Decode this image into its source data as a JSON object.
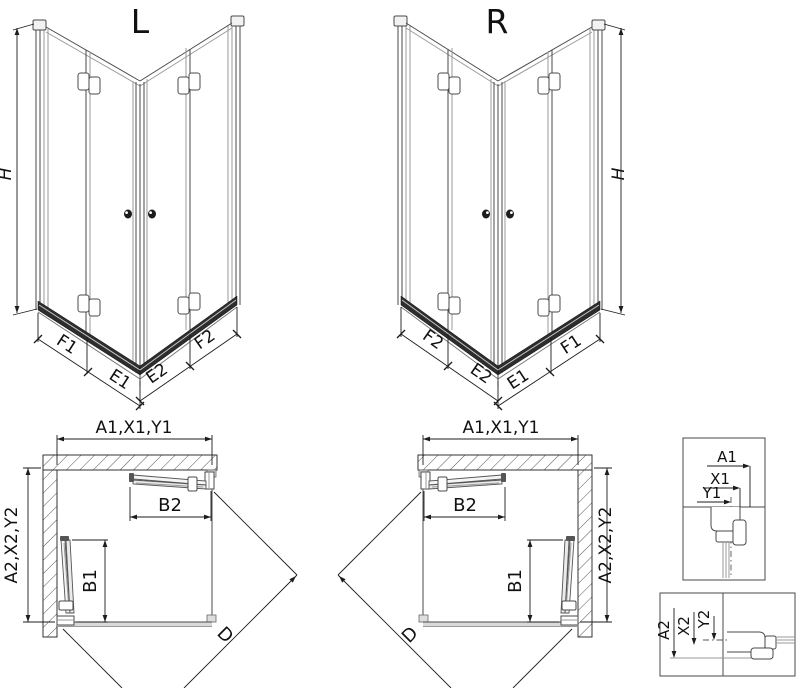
{
  "drawing": {
    "views3d": {
      "left": {
        "title": "L",
        "h": "H",
        "left_outer": "F1",
        "left_inner": "E1",
        "right_inner": "E2",
        "right_outer": "F2"
      },
      "right": {
        "title": "R",
        "h": "H",
        "left_outer": "F2",
        "left_inner": "E2",
        "right_inner": "E1",
        "right_outer": "F1"
      }
    },
    "plans": {
      "left": {
        "top_dim": "A1,X1,Y1",
        "side_dim": "A2,X2,Y2",
        "door_top_dim": "B2",
        "door_side_dim": "B1",
        "diagonal_dim": "D"
      },
      "right": {
        "top_dim": "A1,X1,Y1",
        "side_dim": "A2,X2,Y2",
        "door_top_dim": "B2",
        "door_side_dim": "B1",
        "diagonal_dim": "D"
      }
    },
    "details": {
      "horizontal": {
        "a1": "A1",
        "x1": "X1",
        "y1": "Y1"
      },
      "vertical": {
        "a2": "A2",
        "x2": "X2",
        "y2": "Y2"
      }
    },
    "colors": {
      "line": "#4a4a4a",
      "glass": "#9a9a9a",
      "dimension": "#1c1c1c",
      "rail": "#2d2d2d",
      "background": "#ffffff"
    }
  }
}
